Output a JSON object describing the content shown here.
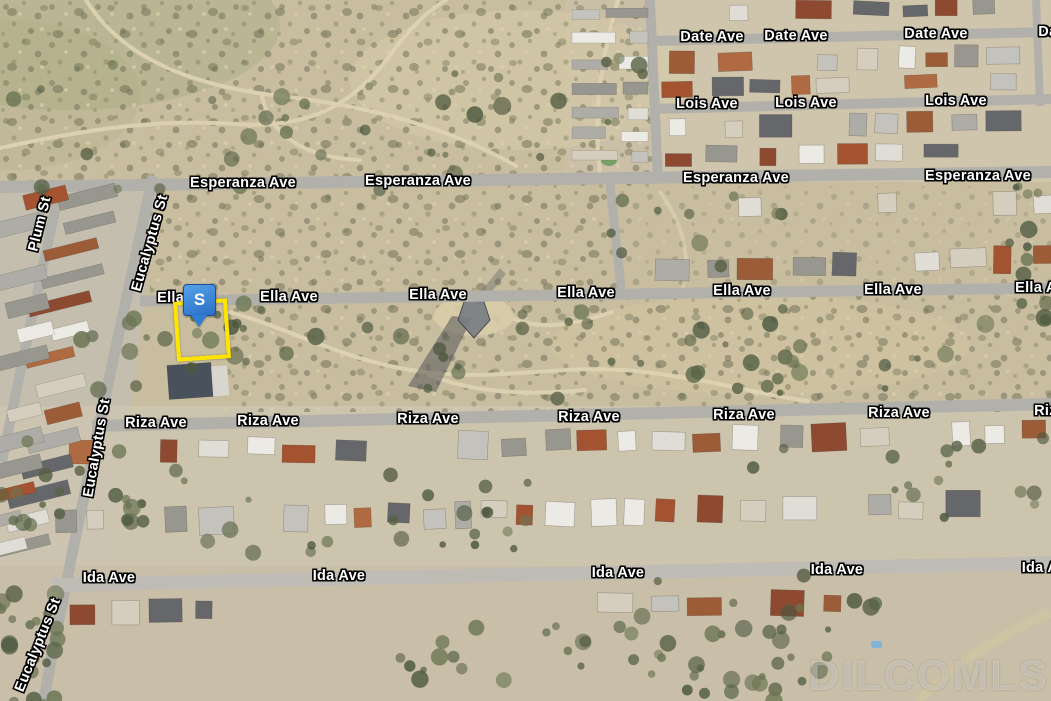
{
  "map": {
    "watermark": "DILCOMLS",
    "marker": {
      "label": "S",
      "color": "#2f80d5"
    },
    "parcel": {
      "outline_color": "#ffe400"
    },
    "street_labels": [
      {
        "text": "Date Ave",
        "x": 712,
        "y": 37,
        "rot": 0
      },
      {
        "text": "Date Ave",
        "x": 796,
        "y": 36,
        "rot": 0
      },
      {
        "text": "Date Ave",
        "x": 936,
        "y": 34,
        "rot": 0
      },
      {
        "text": "Date Ave",
        "x": 1070,
        "y": 32,
        "rot": 0
      },
      {
        "text": "Lois Ave",
        "x": 707,
        "y": 104,
        "rot": 0
      },
      {
        "text": "Lois Ave",
        "x": 806,
        "y": 103,
        "rot": 0
      },
      {
        "text": "Lois Ave",
        "x": 956,
        "y": 101,
        "rot": 0
      },
      {
        "text": "Esperanza Ave",
        "x": 243,
        "y": 183,
        "rot": 0
      },
      {
        "text": "Esperanza Ave",
        "x": 418,
        "y": 181,
        "rot": 0
      },
      {
        "text": "Esperanza Ave",
        "x": 736,
        "y": 178,
        "rot": 0
      },
      {
        "text": "Esperanza Ave",
        "x": 978,
        "y": 176,
        "rot": 0
      },
      {
        "text": "Ella Ave",
        "x": 186,
        "y": 298,
        "rot": 0
      },
      {
        "text": "Ella Ave",
        "x": 289,
        "y": 297,
        "rot": 0
      },
      {
        "text": "Ella Ave",
        "x": 438,
        "y": 295,
        "rot": 0
      },
      {
        "text": "Ella Ave",
        "x": 586,
        "y": 293,
        "rot": 0
      },
      {
        "text": "Ella Ave",
        "x": 742,
        "y": 291,
        "rot": 0
      },
      {
        "text": "Ella Ave",
        "x": 893,
        "y": 290,
        "rot": 0
      },
      {
        "text": "Ella Ave",
        "x": 1044,
        "y": 288,
        "rot": 0
      },
      {
        "text": "Riza Ave",
        "x": 156,
        "y": 423,
        "rot": 0
      },
      {
        "text": "Riza Ave",
        "x": 268,
        "y": 421,
        "rot": 0
      },
      {
        "text": "Riza Ave",
        "x": 428,
        "y": 419,
        "rot": 0
      },
      {
        "text": "Riza Ave",
        "x": 589,
        "y": 417,
        "rot": 0
      },
      {
        "text": "Riza Ave",
        "x": 744,
        "y": 415,
        "rot": 0
      },
      {
        "text": "Riza Ave",
        "x": 899,
        "y": 413,
        "rot": 0
      },
      {
        "text": "Riza Ave",
        "x": 1065,
        "y": 411,
        "rot": 0
      },
      {
        "text": "Ida Ave",
        "x": 109,
        "y": 578,
        "rot": 0
      },
      {
        "text": "Ida Ave",
        "x": 339,
        "y": 576,
        "rot": 0
      },
      {
        "text": "Ida Ave",
        "x": 618,
        "y": 573,
        "rot": 0
      },
      {
        "text": "Ida Ave",
        "x": 837,
        "y": 570,
        "rot": 0
      },
      {
        "text": "Ida Ave",
        "x": 1048,
        "y": 568,
        "rot": 0
      },
      {
        "text": "Plum St",
        "x": 40,
        "y": 224,
        "rot": -76
      },
      {
        "text": "Eucalyptus St",
        "x": 150,
        "y": 243,
        "rot": -74
      },
      {
        "text": "Eucalyptus St",
        "x": 97,
        "y": 448,
        "rot": -80
      },
      {
        "text": "Eucalyptus St",
        "x": 38,
        "y": 645,
        "rot": -68
      }
    ]
  }
}
